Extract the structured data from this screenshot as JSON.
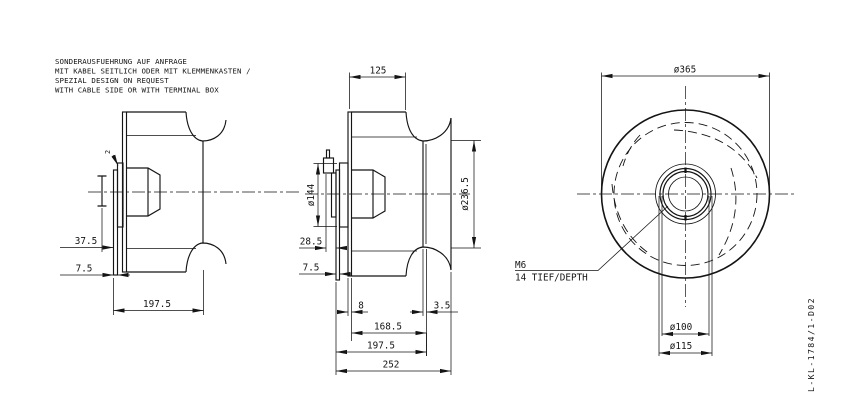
{
  "drawing": {
    "notes": [
      "SONDERAUSFUEHRUNG AUF ANFRAGE",
      "MIT KABEL SEITLICH ODER MIT KLEMMENKASTEN /",
      "SPEZIAL DESIGN ON REQUEST",
      "WITH CABLE SIDE OR WITH TERMINAL BOX"
    ],
    "drawing_number": "L-KL-1784/1-D02",
    "views": {
      "left_side": {
        "dims": {
          "hub_offset": "37.5",
          "plate_thickness": "7.5",
          "impeller_depth": "197.5",
          "gap": "2"
        }
      },
      "middle_section": {
        "dims": {
          "inlet_depth": "125",
          "motor_flange": "ø144",
          "inlet_ring": "ø236.5",
          "cable_offset": "28.5",
          "plate_thickness": "7.5",
          "backplate": "8",
          "ring_sheet": "3.5",
          "depth_inner": "168.5",
          "depth": "197.5",
          "overall_depth": "252"
        }
      },
      "front": {
        "dims": {
          "outer_diameter": "ø365",
          "hub_spigot": "ø100",
          "hub_flange": "ø115"
        },
        "thread_note": [
          "M6",
          "14 TIEF/DEPTH"
        ]
      }
    },
    "colors": {
      "ink": "#141414",
      "background": "#ffffff"
    }
  }
}
